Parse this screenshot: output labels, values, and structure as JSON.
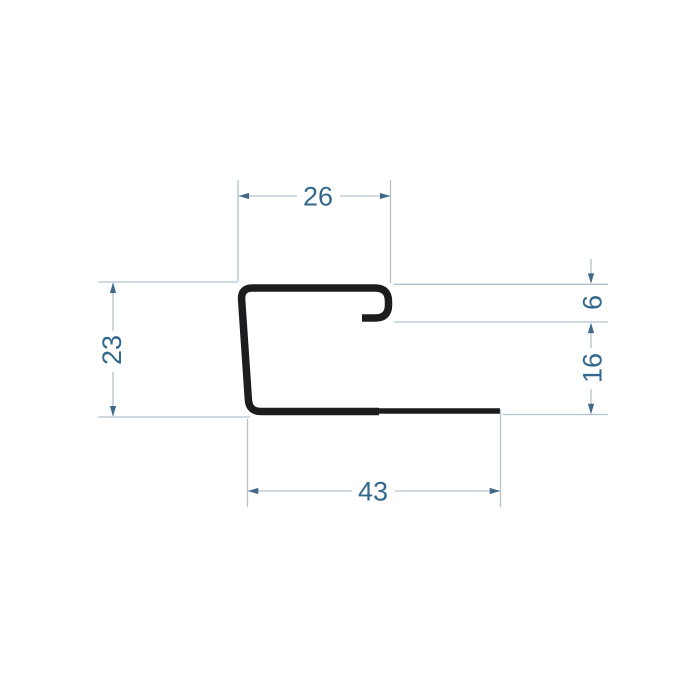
{
  "page": {
    "background": "#ffffff"
  },
  "drawing": {
    "kind": "technical-profile-cross-section",
    "profile": {
      "description": "J-shaped trim profile: top channel with downward hook lip on the right, slightly slanted left wall, long bottom flange extending right",
      "stroke_color": "#1d1d1f"
    },
    "dimensions": {
      "top_width": {
        "label": "26",
        "value": 26,
        "orientation": "horizontal",
        "measures": "top channel outer width"
      },
      "left_height": {
        "label": "23",
        "value": 23,
        "orientation": "vertical",
        "measures": "overall profile height, left side"
      },
      "hook_height": {
        "label": "6",
        "value": 6,
        "orientation": "vertical",
        "measures": "top edge to bottom of hook lip"
      },
      "lower_right_height": {
        "label": "16",
        "value": 16,
        "orientation": "vertical",
        "measures": "hook lip to bottom flange"
      },
      "bottom_width": {
        "label": "43",
        "value": 43,
        "orientation": "horizontal",
        "measures": "bottom flange length"
      }
    },
    "colors": {
      "background": "#ffffff",
      "profile_stroke": "#1d1d1f",
      "dimension_line": "#b2c2cc",
      "arrow": "#40688a",
      "dimension_text": "#33688e"
    }
  }
}
